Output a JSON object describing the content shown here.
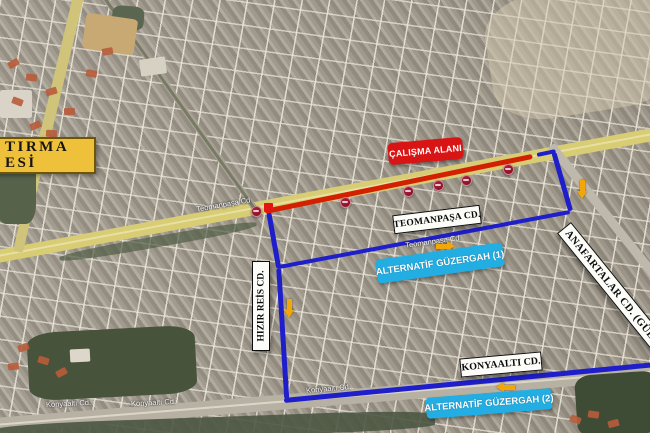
{
  "map": {
    "hospital_box": {
      "lines": [
        "TIRMA",
        "ESİ"
      ],
      "bg": "#efc13b"
    },
    "work_area": {
      "label": "ÇALIŞMA ALANI",
      "bg": "#d81414"
    },
    "street_labels": {
      "teomanpasa": "TEOMANPAŞA CD.",
      "konyaalti": "KONYAALTI CD.",
      "hizir_reis": "HIZIR REİS CD.",
      "anafartalar": "ANAFARTALAR CD. (GÜLLÜK"
    },
    "alt_route_labels": {
      "alt1": "ALTERNATİF GÜZERGAH (1)",
      "alt2": "ALTERNATİF GÜZERGAH (2)",
      "bg": "#22aee2"
    },
    "imagery_street_labels": [
      {
        "text": "Teomanpaşa Cd",
        "x": 196,
        "y": 200,
        "rot": -10
      },
      {
        "text": "Teomanpaşa Cd",
        "x": 405,
        "y": 237,
        "rot": -8
      },
      {
        "text": "Konyaaltı Cd.",
        "x": 46,
        "y": 399,
        "rot": -3
      },
      {
        "text": "Konyaaltı Cd.",
        "x": 131,
        "y": 398,
        "rot": -3
      },
      {
        "text": "Konyaaltı Cd.",
        "x": 306,
        "y": 384,
        "rot": -5
      }
    ],
    "overlay": {
      "closed_road": {
        "color": "#d32000",
        "segments": [
          {
            "x1": 265,
            "y1": 211,
            "x2": 532,
            "y2": 156,
            "w": 5
          }
        ],
        "closure_square": {
          "x": 264,
          "y": 203,
          "size": 9,
          "color": "#e21414"
        }
      },
      "no_entry_markers": {
        "color": "#8c1228",
        "positions": [
          {
            "x": 256,
            "y": 211
          },
          {
            "x": 345,
            "y": 202
          },
          {
            "x": 408,
            "y": 191
          },
          {
            "x": 438,
            "y": 185
          },
          {
            "x": 466,
            "y": 180
          },
          {
            "x": 508,
            "y": 169
          }
        ]
      },
      "alternative_routes": {
        "color": "#1e1ecb",
        "segments": [
          {
            "x1": 269,
            "y1": 212,
            "x2": 279,
            "y2": 268,
            "w": 4.5
          },
          {
            "x1": 279,
            "y1": 268,
            "x2": 287,
            "y2": 399,
            "w": 4.5
          },
          {
            "x1": 284,
            "y1": 400,
            "x2": 656,
            "y2": 364,
            "w": 5
          },
          {
            "x1": 279,
            "y1": 267,
            "x2": 570,
            "y2": 212,
            "w": 4
          },
          {
            "x1": 554,
            "y1": 152,
            "x2": 571,
            "y2": 211,
            "w": 4.5
          },
          {
            "x1": 537,
            "y1": 155,
            "x2": 556,
            "y2": 151,
            "w": 4
          }
        ]
      },
      "direction_arrows": {
        "color": "#f2a60a",
        "items": [
          {
            "x": 436,
            "y": 241,
            "dir": "right"
          },
          {
            "x": 577,
            "y": 180,
            "dir": "down"
          },
          {
            "x": 284,
            "y": 299,
            "dir": "down"
          },
          {
            "x": 496,
            "y": 382,
            "dir": "left"
          }
        ]
      }
    }
  }
}
